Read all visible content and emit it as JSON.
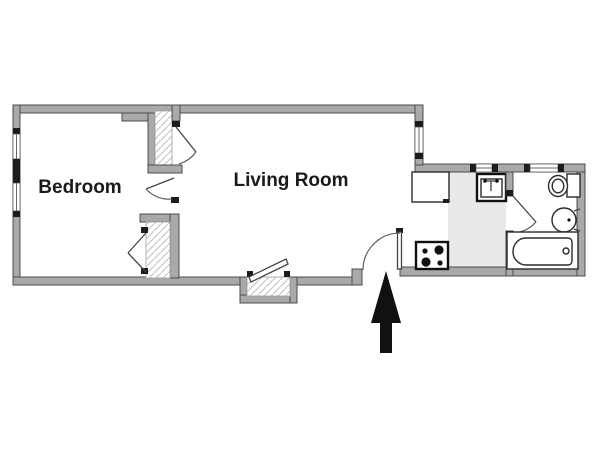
{
  "rooms": {
    "bedroom": {
      "label": "Bedroom"
    },
    "living_room": {
      "label": "Living Room"
    }
  },
  "icons": {
    "entrance_arrow": "arrow-up",
    "window": "wall-window-with-end-caps",
    "door": "quarter-swing-door",
    "closet": "hatched-closet",
    "bifold_door": "zigzag-bifold-door",
    "refrigerator": "counter-unit-box",
    "kitchen_sink": "square-sink-with-faucet",
    "stove": "four-burner-stove",
    "toilet": "toilet-bowl-and-tank",
    "bathroom_sink": "round-basin",
    "bathtub": "bathtub"
  },
  "colors": {
    "background": "#ffffff",
    "wall_fill": "#a9a9a9",
    "wall_edge": "#4c4c4c",
    "window_cap": "#1c1c1c",
    "kitchen_floor": "#e9e9e9",
    "hatch_line": "#b9c3b9",
    "fixture_outline": "#2b2b2b",
    "arrow": "#111111"
  }
}
